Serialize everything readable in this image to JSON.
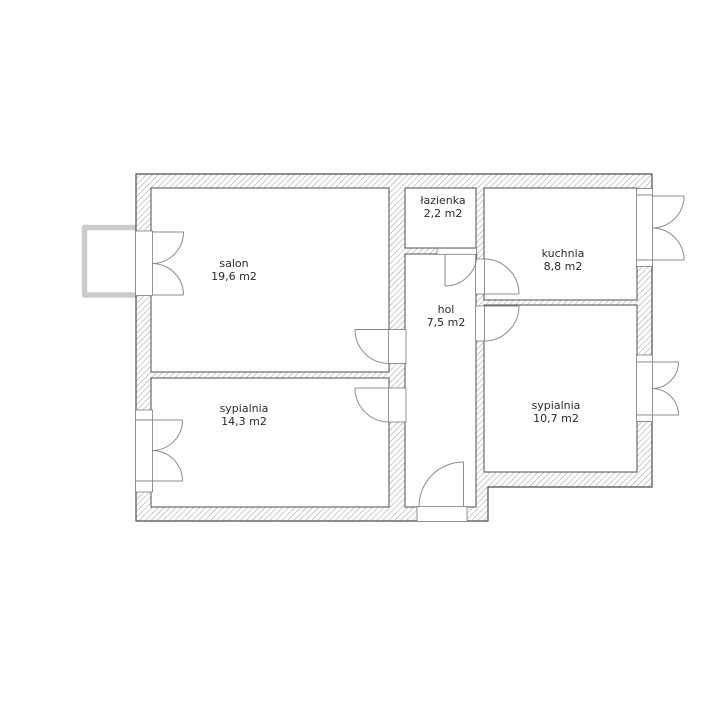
{
  "plan": {
    "type": "apartment-floor-plan",
    "rooms": [
      {
        "id": "salon",
        "name": "salon",
        "area": "19,6 m2"
      },
      {
        "id": "sypialnia-left",
        "name": "sypialnia",
        "area": "14,3 m2"
      },
      {
        "id": "lazienka",
        "name": "łazienka",
        "area": "2,2 m2"
      },
      {
        "id": "hol",
        "name": "hol",
        "area": "7,5 m2"
      },
      {
        "id": "kuchnia",
        "name": "kuchnia",
        "area": "8,8 m2"
      },
      {
        "id": "sypialnia-right",
        "name": "sypialnia",
        "area": "10,7 m2"
      }
    ],
    "colors": {
      "background": "#ffffff",
      "wall_hatch": "#9a9a9a",
      "wall_outline": "#4c4c4c",
      "opening_outline": "#7a7a7a",
      "door_symbol": "#8c8c8c",
      "balcony_railing": "#cbcbcb",
      "label_text": "#2b2b2b"
    }
  }
}
